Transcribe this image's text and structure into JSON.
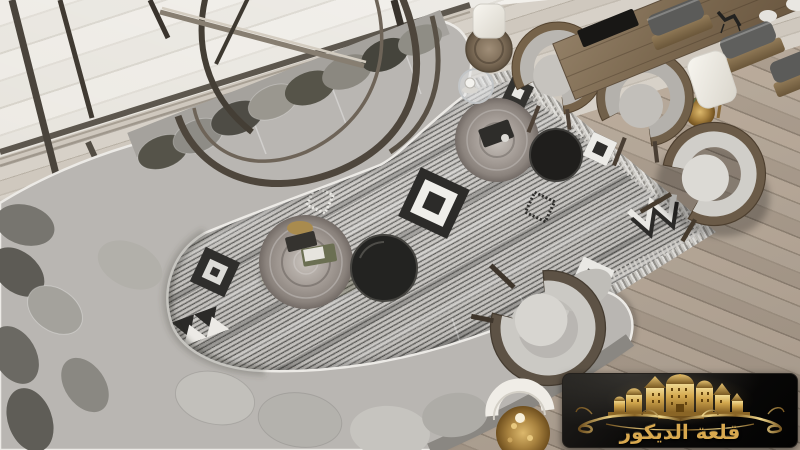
{
  "scene": {
    "type": "interior-photograph",
    "description": "Top-down view of a luxury living room: a long curved grey modular sofa wraps around a tribal-patterned grey rug with tree-trunk and black round coffee tables; wooden armchairs with grey cushions, a dining table with cane chairs, white table lamps and a window wall with a metal ring sculpture; pale wood plank flooring.",
    "objects": [
      "curved-sectional-sofa",
      "throw-pillows",
      "tribal-area-rug",
      "tree-trunk-coffee-table",
      "black-round-side-table",
      "glass-side-table",
      "log-side-stool",
      "wooden-armchair",
      "dining-table",
      "cane-dining-chairs",
      "white-table-lamp",
      "gold-branch-lamp",
      "metal-ring-sculpture",
      "window-wall",
      "wood-plank-floor",
      "brand-watermark"
    ]
  },
  "palette": {
    "floor_wood": "#b3a697",
    "exterior_stone": "#ebe8e2",
    "rug_light": "#ccc9c5",
    "rug_dark": "#504f4c",
    "sofa_grey": "#b9b6b2",
    "pillow_dark": "#55534a",
    "wood_frame": "#76634a",
    "table_black": "#232321",
    "lamp_shade": "#f5f3ed",
    "logo_background": "#0b0a09",
    "logo_gold": "#d0a050"
  },
  "logo": {
    "brand_text": "قلعة الديكور",
    "emblem": "golden-castle-illustration",
    "ornament": "golden-scroll-flourish",
    "background": "#0b0a09",
    "gold": "#d9a94f"
  }
}
